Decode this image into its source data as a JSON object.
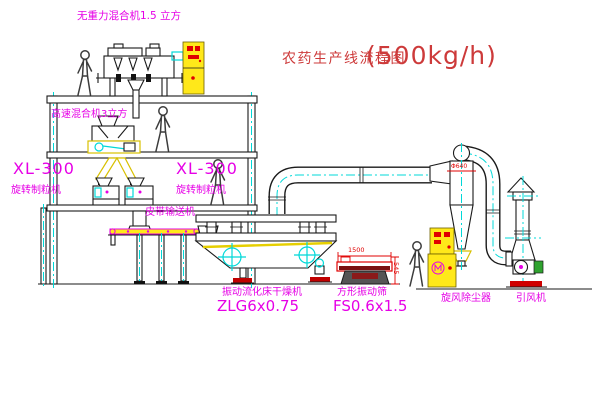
{
  "title": {
    "name": "农药生产线流程图",
    "capacity": "(500kg/h)"
  },
  "equipment_labels": {
    "gravity_mixer": "无重力混合机1.5 立方",
    "high_speed_mixer": "高速混合机3立方",
    "granulator_left": {
      "model": "XL-300",
      "name": "旋转制粒机"
    },
    "granulator_mid": {
      "model": "XL-300",
      "name": "旋转制粒机"
    },
    "belt_conveyor": "皮带输送机",
    "fluid_bed_dryer": {
      "name": "振动流化床干燥机",
      "model": "ZLG6x0.75"
    },
    "vibrating_sieve": {
      "name": "方形振动筛",
      "model": "FS0.6x1.5"
    },
    "cyclone": "旋风除尘器",
    "induced_draft_fan": "引风机"
  },
  "dimensions": {
    "sieve_length": "1500",
    "sieve_height": "545",
    "cyclone_diameter": "Φ640"
  },
  "colors": {
    "line_black": "#1a1a1a",
    "centerline_cyan": "#00d8d8",
    "label_magenta": "#e600e6",
    "title_red": "#cd3a3a",
    "dimension_red": "#e00000",
    "cabinet_yellow": "#ffe81a",
    "chute_yellow": "#d8c000"
  }
}
